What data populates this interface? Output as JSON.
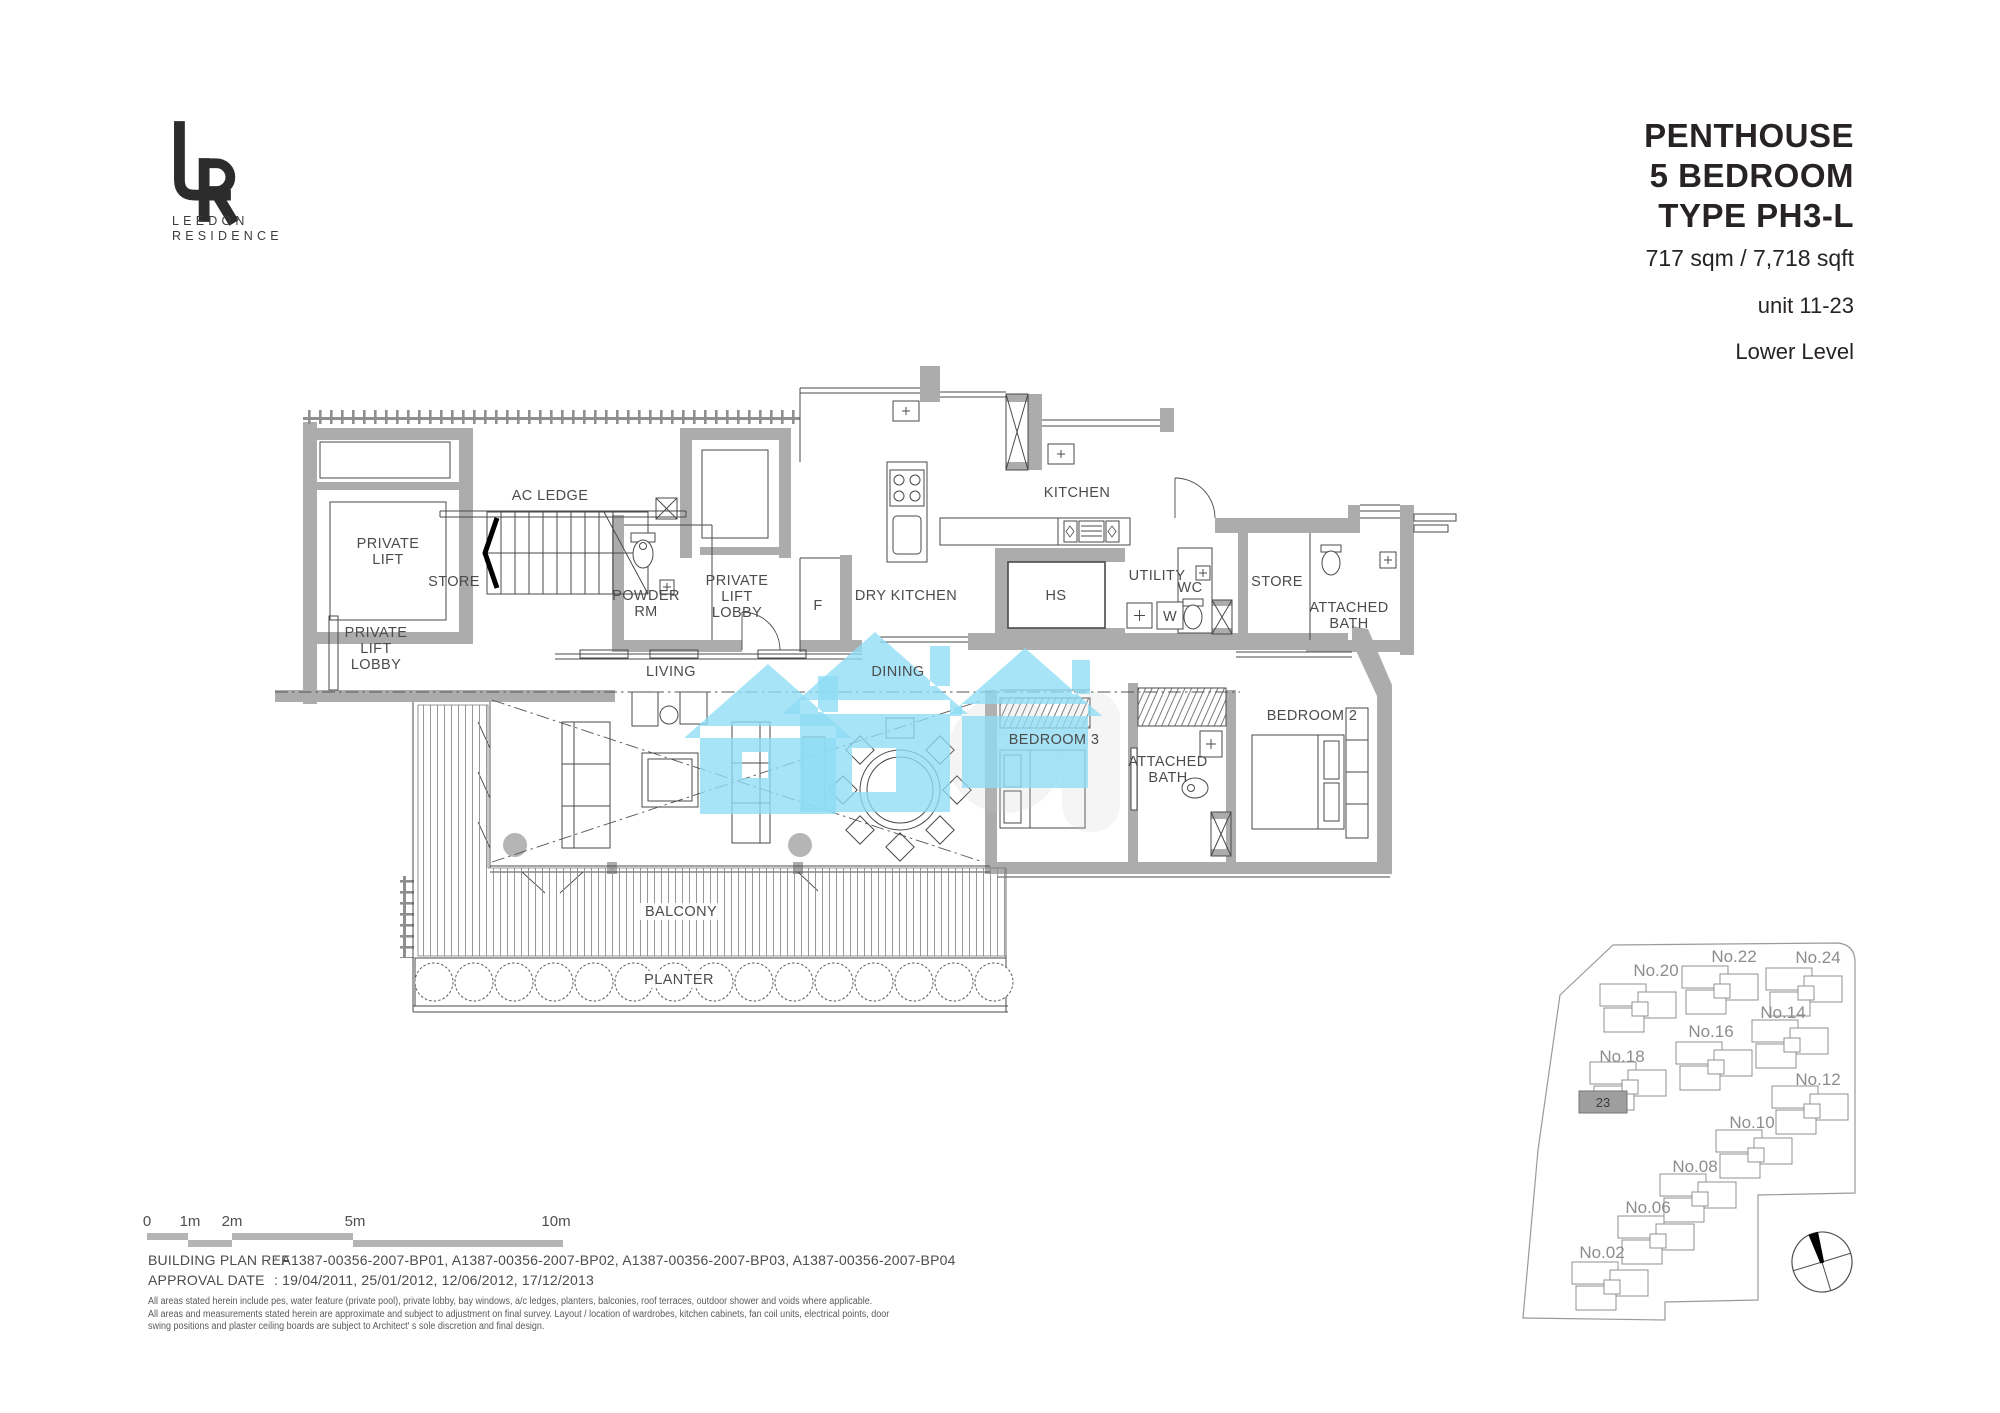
{
  "brand": {
    "monogram_lines": [
      "LEEDON",
      "RESIDENCE"
    ]
  },
  "title": {
    "lines": [
      "PENTHOUSE",
      "5 BEDROOM",
      "TYPE  PH3-L"
    ],
    "area": "717 sqm / 7,718 sqft",
    "unit": "unit 11-23",
    "level": "Lower Level"
  },
  "floorplan": {
    "labels": [
      {
        "id": "ac-ledge",
        "text": "AC LEDGE",
        "x": 550,
        "y": 500
      },
      {
        "id": "private-lift",
        "text": "PRIVATE\nLIFT",
        "x": 388,
        "y": 548
      },
      {
        "id": "store-1",
        "text": "STORE",
        "x": 454,
        "y": 586
      },
      {
        "id": "powder-rm",
        "text": "POWDER\nRM",
        "x": 646,
        "y": 600
      },
      {
        "id": "private-lift-lobby-upper",
        "text": "PRIVATE\nLIFT\nLOBBY",
        "x": 737,
        "y": 585
      },
      {
        "id": "f-closet",
        "text": "F",
        "x": 818,
        "y": 610
      },
      {
        "id": "dry-kitchen",
        "text": "DRY KITCHEN",
        "x": 906,
        "y": 600
      },
      {
        "id": "kitchen",
        "text": "KITCHEN",
        "x": 1077,
        "y": 497
      },
      {
        "id": "hs",
        "text": "HS",
        "x": 1056,
        "y": 600
      },
      {
        "id": "utility",
        "text": "UTILITY",
        "x": 1157,
        "y": 580
      },
      {
        "id": "wc",
        "text": "WC",
        "x": 1190,
        "y": 592
      },
      {
        "id": "w-washer",
        "text": "W",
        "x": 1170,
        "y": 621
      },
      {
        "id": "store-2",
        "text": "STORE",
        "x": 1277,
        "y": 586
      },
      {
        "id": "attached-bath-top",
        "text": "ATTACHED\nBATH",
        "x": 1349,
        "y": 612
      },
      {
        "id": "private-lift-lobby-lower",
        "text": "PRIVATE\nLIFT\nLOBBY",
        "x": 376,
        "y": 637
      },
      {
        "id": "living",
        "text": "LIVING",
        "x": 671,
        "y": 676
      },
      {
        "id": "dining",
        "text": "DINING",
        "x": 898,
        "y": 676
      },
      {
        "id": "bedroom-3",
        "text": "BEDROOM 3",
        "x": 1054,
        "y": 744
      },
      {
        "id": "attached-bath-mid",
        "text": "ATTACHED\nBATH",
        "x": 1168,
        "y": 766
      },
      {
        "id": "bedroom-2",
        "text": "BEDROOM 2",
        "x": 1312,
        "y": 720
      },
      {
        "id": "balcony",
        "text": "BALCONY",
        "x": 681,
        "y": 916
      },
      {
        "id": "planter",
        "text": "PLANTER",
        "x": 679,
        "y": 984
      }
    ]
  },
  "footer": {
    "scalebar": {
      "ticks": [
        {
          "label": "0",
          "x": 147
        },
        {
          "label": "1m",
          "x": 190
        },
        {
          "label": "2m",
          "x": 232
        },
        {
          "label": "5m",
          "x": 355
        },
        {
          "label": "10m",
          "x": 556
        }
      ],
      "segments": [
        {
          "x": 147,
          "w": 41,
          "row": 0
        },
        {
          "x": 188,
          "w": 44,
          "row": 1
        },
        {
          "x": 232,
          "w": 121,
          "row": 0
        },
        {
          "x": 353,
          "w": 210,
          "row": 1
        }
      ]
    },
    "building_plan_ref": {
      "label": "BUILDING PLAN REF",
      "value": ": A1387-00356-2007-BP01, A1387-00356-2007-BP02, A1387-00356-2007-BP03, A1387-00356-2007-BP04"
    },
    "approval_date": {
      "label": "APPROVAL DATE",
      "value": ": 19/04/2011, 25/01/2012, 12/06/2012, 17/12/2013"
    },
    "disclaimer_lines": [
      "All areas stated herein include pes, water feature (private pool), private lobby, bay windows, a/c ledges, planters, balconies, roof terraces, outdoor shower and voids where applicable.",
      "All areas and measurements stated herein are approximate and subject to adjustment on final survey. Layout / location of wardrobes, kitchen cabinets, fan coil units, electrical points, door",
      "swing positions and plaster ceiling boards are subject to Architect' s sole discretion and final design."
    ]
  },
  "sitemap": {
    "highlighted_unit": "23",
    "buildings": [
      {
        "label": "No.20",
        "lx": 1656,
        "ly": 976,
        "bx": 1640,
        "by": 1008
      },
      {
        "label": "No.22",
        "lx": 1734,
        "ly": 962,
        "bx": 1722,
        "by": 990
      },
      {
        "label": "No.24",
        "lx": 1818,
        "ly": 963,
        "bx": 1806,
        "by": 992
      },
      {
        "label": "No.16",
        "lx": 1711,
        "ly": 1037,
        "bx": 1716,
        "by": 1066
      },
      {
        "label": "No.14",
        "lx": 1783,
        "ly": 1018,
        "bx": 1792,
        "by": 1044
      },
      {
        "label": "No.18",
        "lx": 1622,
        "ly": 1062,
        "bx": 1630,
        "by": 1086
      },
      {
        "label": "No.12",
        "lx": 1818,
        "ly": 1085,
        "bx": 1812,
        "by": 1110
      },
      {
        "label": "No.10",
        "lx": 1752,
        "ly": 1128,
        "bx": 1756,
        "by": 1154
      },
      {
        "label": "No.08",
        "lx": 1695,
        "ly": 1172,
        "bx": 1700,
        "by": 1198
      },
      {
        "label": "No.06",
        "lx": 1648,
        "ly": 1213,
        "bx": 1658,
        "by": 1240
      },
      {
        "label": "No.02",
        "lx": 1602,
        "ly": 1258,
        "bx": 1612,
        "by": 1286
      },
      {
        "label": "23",
        "highlighted": true,
        "lx": 1603,
        "ly": 1107,
        "bx": 1603,
        "by": 1102
      }
    ]
  },
  "colors": {
    "wall": "#acacac",
    "watermark_blue": "#8edcf5",
    "scalebar_gray": "#b4b4b4",
    "highlight_gray": "#9e9e9e"
  }
}
